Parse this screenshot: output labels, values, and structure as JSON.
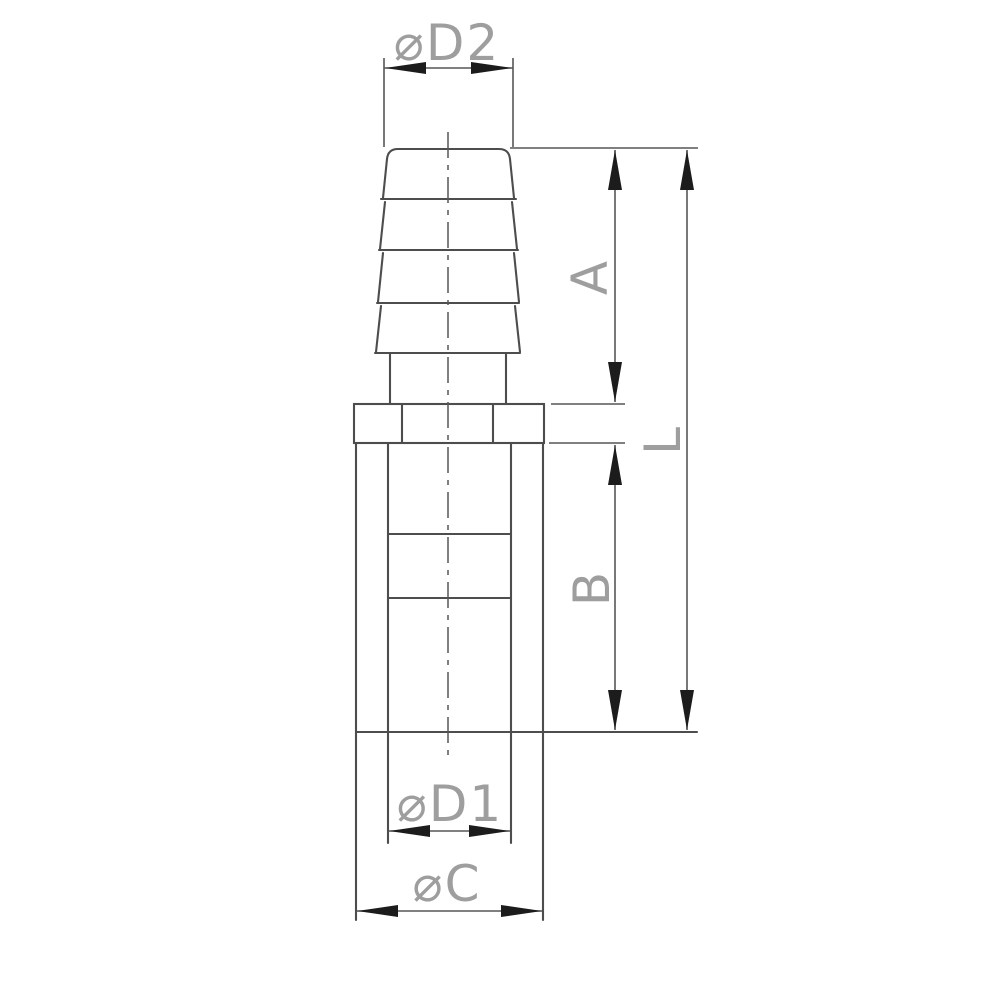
{
  "drawing": {
    "labels": {
      "d2": "⌀D2",
      "a": "A",
      "l": "L",
      "b": "B",
      "d1": "⌀D1",
      "c": "⌀C"
    },
    "colors": {
      "background": "#ffffff",
      "outline": "#4d4d4d",
      "dimension": "#565656",
      "arrow": "#1c1c1c",
      "label": "#9e9e9e"
    }
  }
}
